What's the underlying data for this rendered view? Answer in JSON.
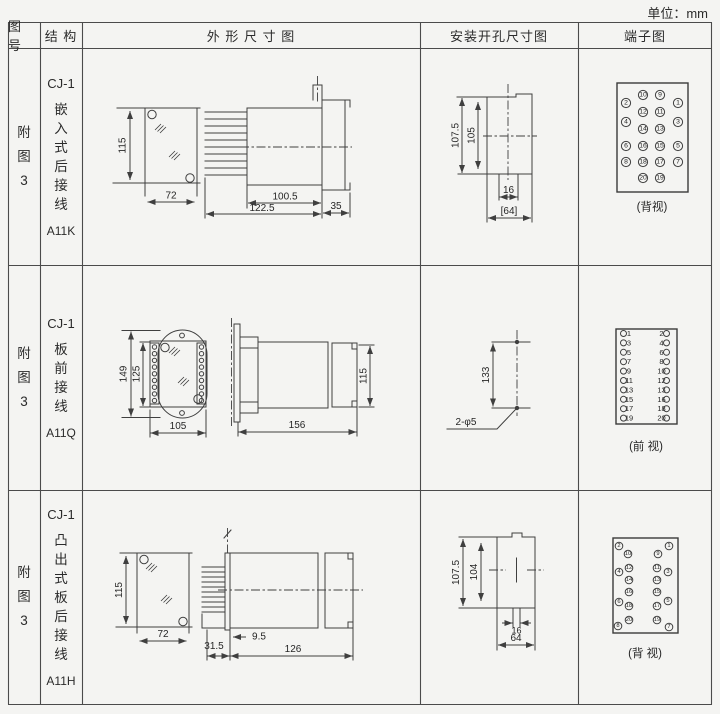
{
  "unit_label": "单位：mm",
  "table": {
    "headers": [
      "图 号",
      "结 构",
      "外 形 尺 寸 图",
      "安装开孔尺寸图",
      "端子图"
    ]
  },
  "rows": [
    {
      "figure_no": "附图3",
      "model": "CJ-1",
      "structure": "嵌入式后接线",
      "code": "A11K",
      "outline_dims": {
        "height": "115",
        "width": "72",
        "depth": "100.5",
        "total_depth": "122.5",
        "flange": "35"
      },
      "mounting_dims": {
        "outer": "107.5",
        "inner": "105",
        "notch": "16",
        "opening": "[64]"
      },
      "terminal": {
        "view": "(背视)",
        "numbers": [
          {
            "n": "10",
            "x": 643,
            "y": 95
          },
          {
            "n": "9",
            "x": 660,
            "y": 95
          },
          {
            "n": "2",
            "x": 626,
            "y": 103
          },
          {
            "n": "1",
            "x": 678,
            "y": 103
          },
          {
            "n": "12",
            "x": 643,
            "y": 112
          },
          {
            "n": "11",
            "x": 660,
            "y": 112
          },
          {
            "n": "4",
            "x": 626,
            "y": 122
          },
          {
            "n": "3",
            "x": 678,
            "y": 122
          },
          {
            "n": "14",
            "x": 643,
            "y": 129
          },
          {
            "n": "13",
            "x": 660,
            "y": 129
          },
          {
            "n": "6",
            "x": 626,
            "y": 146
          },
          {
            "n": "16",
            "x": 643,
            "y": 146
          },
          {
            "n": "15",
            "x": 660,
            "y": 146
          },
          {
            "n": "5",
            "x": 678,
            "y": 146
          },
          {
            "n": "8",
            "x": 626,
            "y": 162
          },
          {
            "n": "18",
            "x": 643,
            "y": 162
          },
          {
            "n": "17",
            "x": 660,
            "y": 162
          },
          {
            "n": "7",
            "x": 678,
            "y": 162
          },
          {
            "n": "20",
            "x": 643,
            "y": 178
          },
          {
            "n": "19",
            "x": 660,
            "y": 178
          }
        ]
      }
    },
    {
      "figure_no": "附图3",
      "model": "CJ-1",
      "structure": "板前接线",
      "code": "A11Q",
      "outline_dims": {
        "outer_height": "149",
        "inner_height": "125",
        "width": "105",
        "depth": "156",
        "rear_height": "115"
      },
      "mounting_dims": {
        "spacing": "133",
        "holes": "2-φ5"
      },
      "terminal": {
        "view": "(前 视)",
        "pairs": [
          [
            "1",
            "2"
          ],
          [
            "3",
            "4"
          ],
          [
            "5",
            "6"
          ],
          [
            "7",
            "8"
          ],
          [
            "9",
            "10"
          ],
          [
            "11",
            "12"
          ],
          [
            "13",
            "13"
          ],
          [
            "15",
            "16"
          ],
          [
            "17",
            "18"
          ],
          [
            "19",
            "20"
          ]
        ]
      }
    },
    {
      "figure_no": "附图3",
      "model": "CJ-1",
      "structure": "凸出式板后接线",
      "code": "A11H",
      "outline_dims": {
        "height": "115",
        "width": "72",
        "pin_len": "31.5",
        "offset": "9.5",
        "depth": "126"
      },
      "mounting_dims": {
        "outer": "107.5",
        "inner": "104",
        "notch": "16",
        "opening": "64"
      },
      "terminal": {
        "view": "(背 视)",
        "numbers": [
          {
            "n": "2",
            "x": 619,
            "y": 546
          },
          {
            "n": "1",
            "x": 669,
            "y": 546
          },
          {
            "n": "10",
            "x": 628,
            "y": 554
          },
          {
            "n": "9",
            "x": 658,
            "y": 554
          },
          {
            "n": "12",
            "x": 629,
            "y": 568
          },
          {
            "n": "11",
            "x": 657,
            "y": 568
          },
          {
            "n": "4",
            "x": 619,
            "y": 572
          },
          {
            "n": "3",
            "x": 668,
            "y": 572
          },
          {
            "n": "14",
            "x": 629,
            "y": 580
          },
          {
            "n": "13",
            "x": 657,
            "y": 580
          },
          {
            "n": "16",
            "x": 629,
            "y": 592
          },
          {
            "n": "15",
            "x": 657,
            "y": 592
          },
          {
            "n": "6",
            "x": 619,
            "y": 602
          },
          {
            "n": "5",
            "x": 668,
            "y": 601
          },
          {
            "n": "18",
            "x": 629,
            "y": 606
          },
          {
            "n": "17",
            "x": 657,
            "y": 606
          },
          {
            "n": "20",
            "x": 629,
            "y": 620
          },
          {
            "n": "19",
            "x": 657,
            "y": 620
          },
          {
            "n": "8",
            "x": 618,
            "y": 626
          },
          {
            "n": "7",
            "x": 669,
            "y": 627
          }
        ]
      }
    }
  ]
}
